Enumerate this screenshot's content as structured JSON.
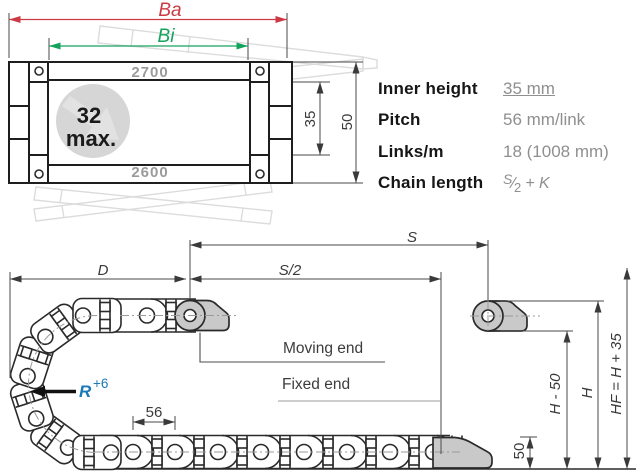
{
  "colors": {
    "accent_red": "#cc3a44",
    "accent_green": "#14a35c",
    "accent_blue": "#1b79b5",
    "line_dark": "#1e1e1e",
    "gray_text": "#9b9b9b",
    "gray_fill": "#c9c9c9"
  },
  "cross_section": {
    "outer_width_label": "Ba",
    "inner_width_label": "Bi",
    "top_part_number": "2700",
    "bottom_part_number": "2600",
    "max_cable_line1": "32",
    "max_cable_line2": "max.",
    "inner_height_dim": "35",
    "outer_height_dim": "50"
  },
  "specs": {
    "rows": [
      {
        "label": "Inner height",
        "value": "35 mm"
      },
      {
        "label": "Pitch",
        "value": "56 mm/link"
      },
      {
        "label": "Links/m",
        "value": "18 (1008 mm)"
      },
      {
        "label": "Chain length"
      }
    ],
    "chain_length": {
      "num": "S",
      "slash": "⁄",
      "den": "2",
      "rest": "+ K"
    }
  },
  "side_view": {
    "travel_label": "S",
    "half_travel_label": "S/2",
    "d_label": "D",
    "radius_label": "R",
    "radius_sup": "+6",
    "pitch_dim": "56",
    "height_50": "50",
    "h_minus_50": "H - 50",
    "h_label": "H",
    "hf_label": "HF = H + 35",
    "moving_end": "Moving end",
    "fixed_end": "Fixed end"
  }
}
